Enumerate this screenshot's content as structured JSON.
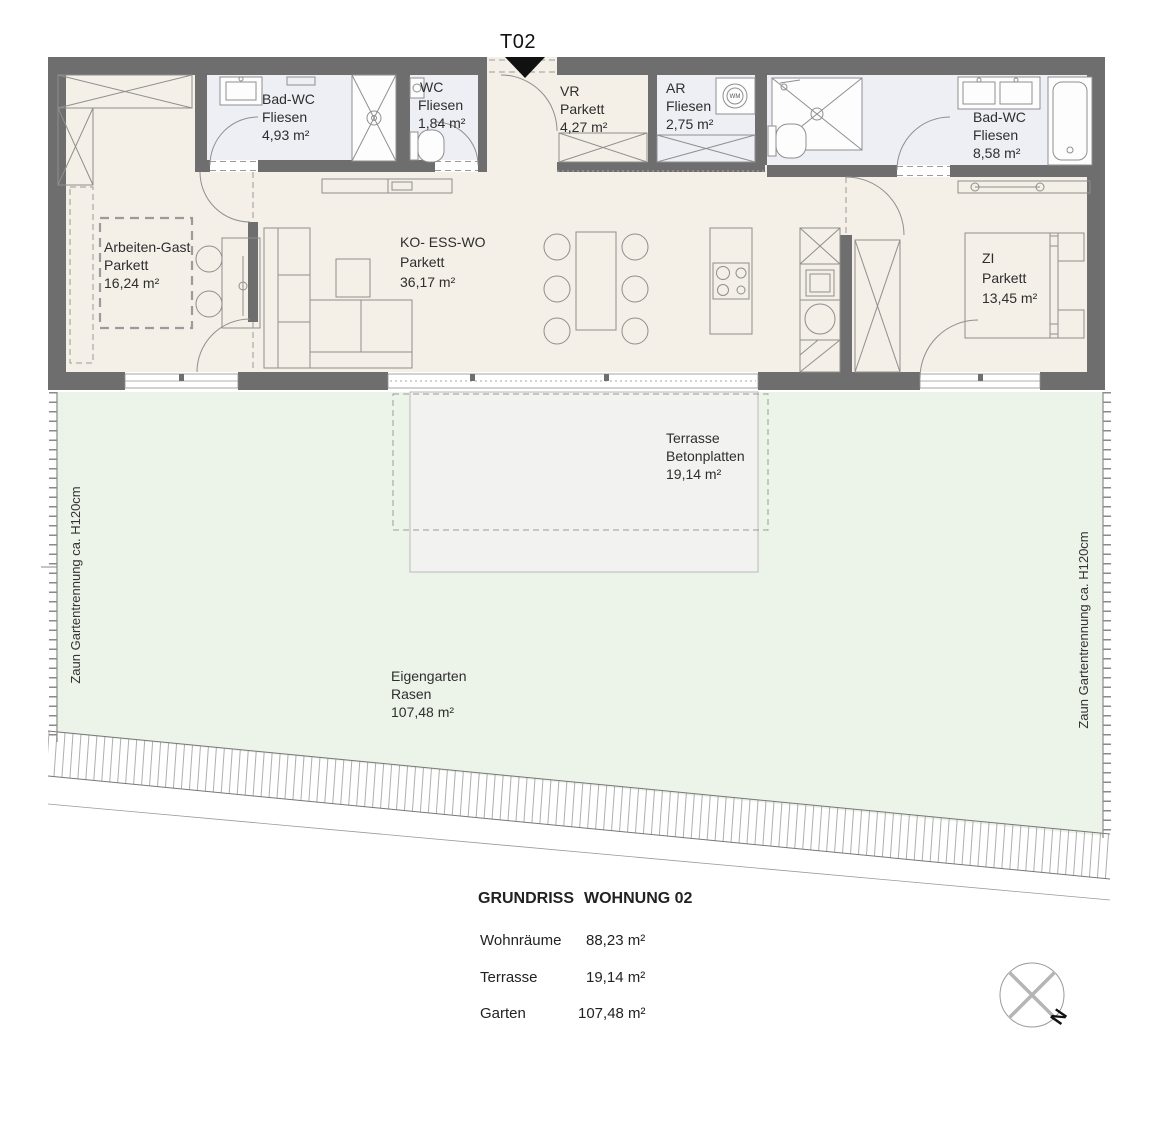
{
  "plan": {
    "entrance": {
      "label": "T02"
    },
    "rooms": [
      {
        "name": "Bad-WC",
        "floor": "Fliesen",
        "area": "4,93 m²"
      },
      {
        "name": "WC",
        "floor": "Fliesen",
        "area": "1,84 m²"
      },
      {
        "name": "VR",
        "floor": "Parkett",
        "area": "4,27 m²"
      },
      {
        "name": "AR",
        "floor": "Fliesen",
        "area": "2,75 m²"
      },
      {
        "name": "Bad-WC",
        "floor": "Fliesen",
        "area": "8,58 m²"
      },
      {
        "name": "Arbeiten-Gast",
        "floor": "Parkett",
        "area": "16,24 m²"
      },
      {
        "name": "KO- ESS-WO",
        "floor": "Parkett",
        "area": "36,17 m²"
      },
      {
        "name": "ZI",
        "floor": "Parkett",
        "area": "13,45 m²"
      }
    ],
    "outdoor": {
      "terrace": {
        "name": "Terrasse",
        "floor": "Betonplatten",
        "area": "19,14 m²"
      },
      "garden": {
        "name": "Eigengarten",
        "floor": "Rasen",
        "area": "107,48 m²"
      }
    },
    "fence": {
      "left_label": "Zaun Gartentrennung ca. H120cm",
      "right_label": "Zaun Gartentrennung ca. H120cm"
    },
    "compass": {
      "north_label": "N"
    },
    "appliances": {
      "washing_machine": "WM"
    }
  },
  "legend": {
    "title": "GRUNDRISS",
    "subtitle": "WOHNUNG 02",
    "rows": [
      {
        "label": "Wohnräume",
        "value": "88,23 m²"
      },
      {
        "label": "Terrasse",
        "value": "19,14 m²"
      },
      {
        "label": "Garten",
        "value": "107,48 m²"
      }
    ]
  },
  "colors": {
    "wall": "#6e6e6e",
    "parkett": "#f4efe7",
    "tiles": "#edeff4",
    "garden": "#ecf3e9",
    "terrace": "#f2f2f0",
    "line": "#8f8f8f",
    "text": "#2e2e2e"
  }
}
